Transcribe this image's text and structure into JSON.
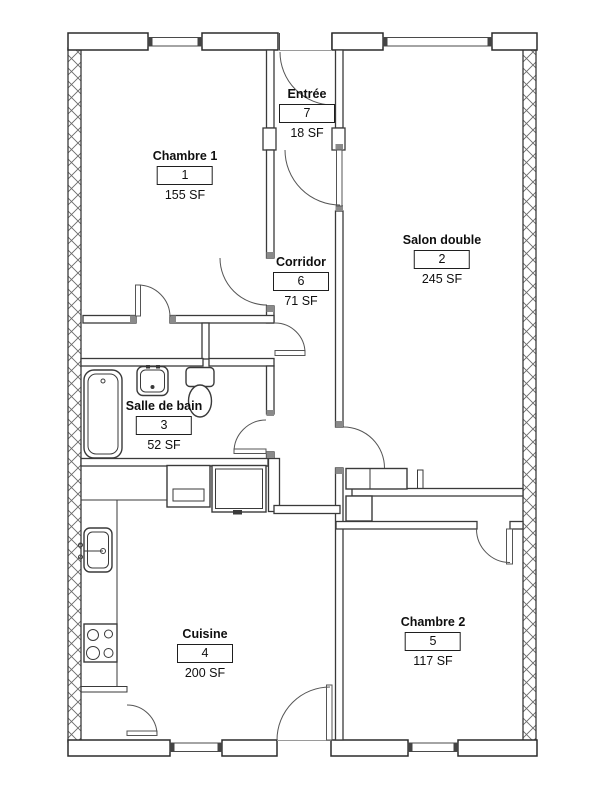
{
  "floorplan": {
    "units_suffix": "SF",
    "rooms": [
      {
        "name": "Chambre 1",
        "number": "1",
        "area": "155 SF"
      },
      {
        "name": "Salon double",
        "number": "2",
        "area": "245 SF"
      },
      {
        "name": "Salle de bain",
        "number": "3",
        "area": "52 SF"
      },
      {
        "name": "Cuisine",
        "number": "4",
        "area": "200 SF"
      },
      {
        "name": "Chambre 2",
        "number": "5",
        "area": "117 SF"
      },
      {
        "name": "Corridor",
        "number": "6",
        "area": "71 SF"
      },
      {
        "name": "Entrée",
        "number": "7",
        "area": "18 SF"
      }
    ],
    "colors": {
      "background": "#ffffff",
      "wall_line": "#3a3a3a",
      "text": "#0f0f0f"
    }
  }
}
